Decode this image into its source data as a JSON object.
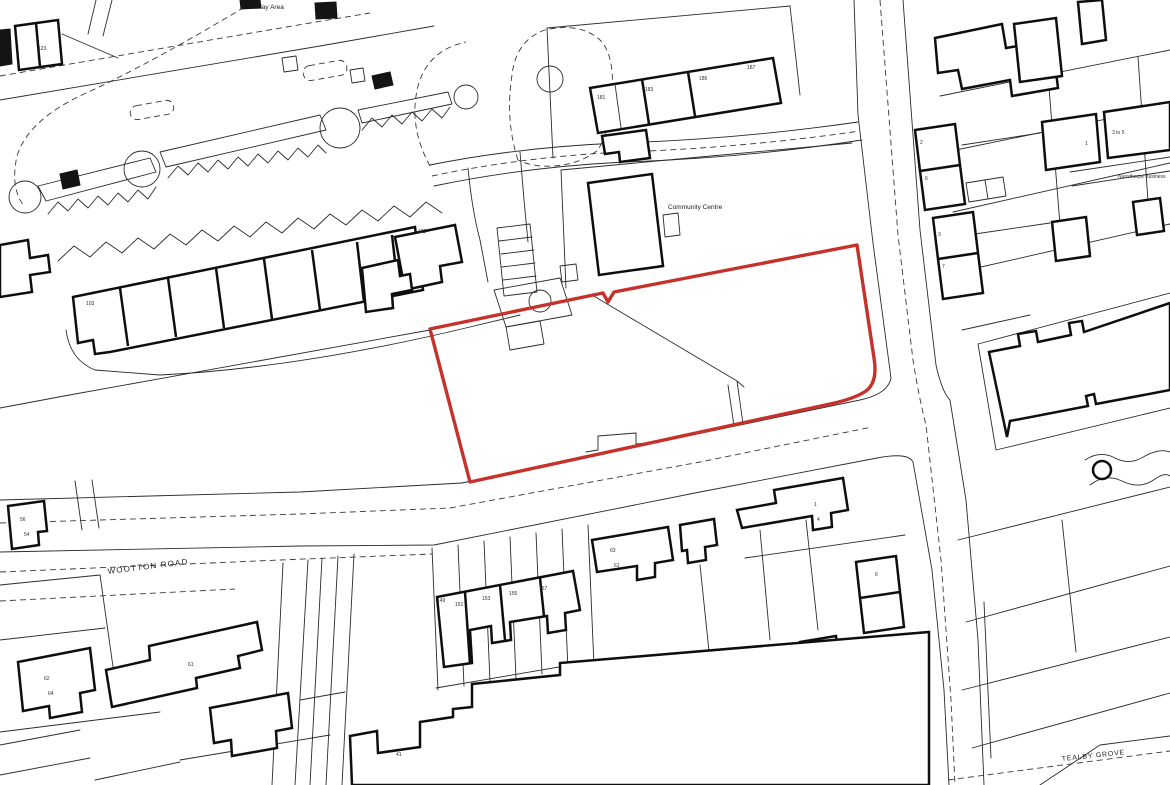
{
  "map": {
    "background_color": "#ffffff",
    "line_color": "#2b2b2b",
    "site_boundary_color": "#c5312b",
    "street_labels": {
      "wootton_road": "WOOTTON ROAD",
      "tealby_grove": "TEALBY GROVE"
    },
    "place_labels": {
      "play_area": "Play Area",
      "community_centre": "Community Centre",
      "business": "Nunsthorpe Business"
    },
    "numbers": [
      "123",
      "103",
      "122",
      "181",
      "183",
      "185",
      "187",
      "2",
      "6",
      "3",
      "7",
      "1",
      "3 to 5",
      "56",
      "54",
      "62",
      "64",
      "61",
      "149",
      "151",
      "153",
      "155",
      "157",
      "63",
      "61",
      "1",
      "4",
      "6",
      "41"
    ]
  }
}
